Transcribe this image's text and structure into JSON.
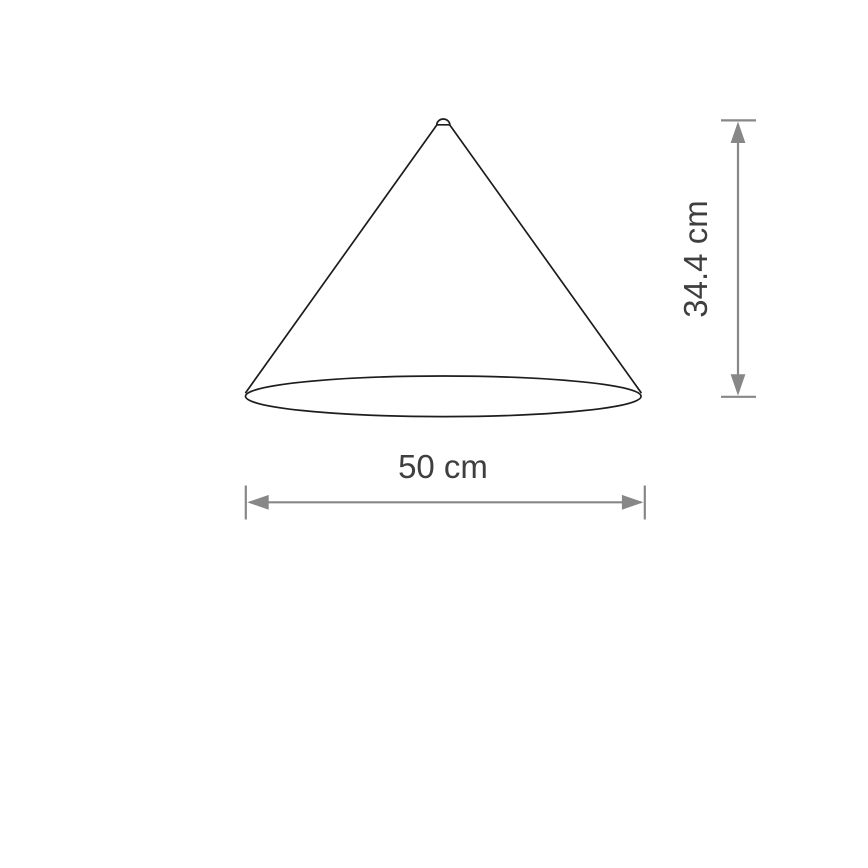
{
  "diagram": {
    "type": "technical-dimension-drawing",
    "subject": "cone lampshade",
    "labels": {
      "width": "50 cm",
      "height": "34.4 cm"
    },
    "colors": {
      "outline": "#1d1d1b",
      "dimension": "#878787",
      "label_text": "#3f3f3f",
      "background": "#ffffff"
    }
  }
}
